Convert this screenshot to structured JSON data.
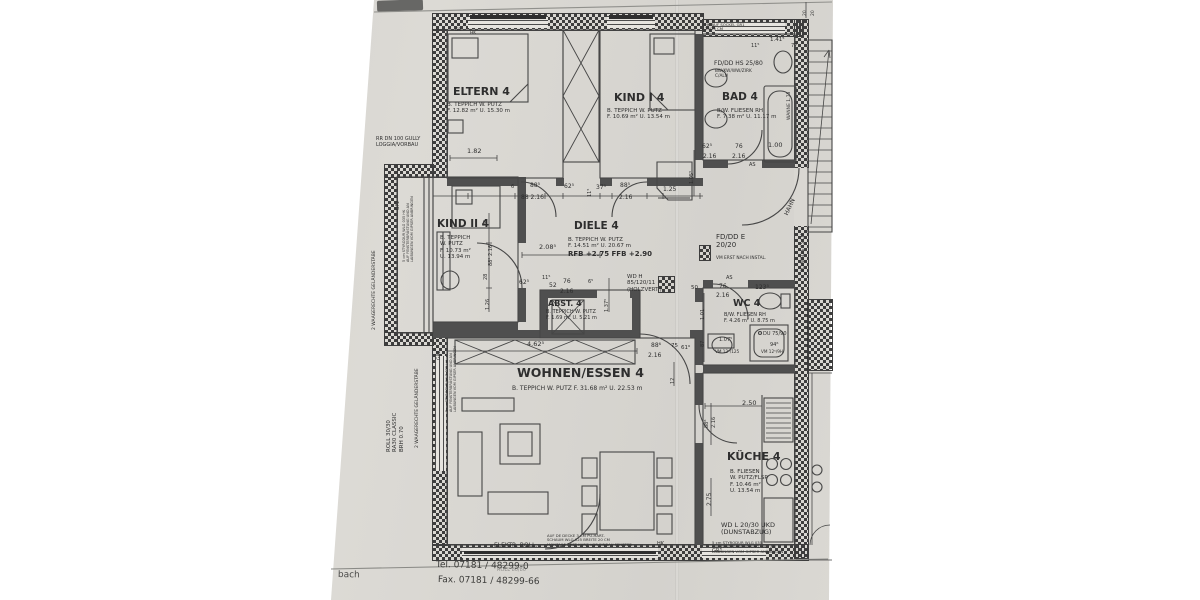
{
  "title": "apartment floor plan sheet (photo)",
  "accent_colors": {
    "paper": "#d6d4cf",
    "ink": "#3d3d3d"
  },
  "footer": {
    "left_fragment": "bach",
    "tel": "Tel. 07181 / 48299-0",
    "fax": "Fax. 07181 / 48299-66",
    "faint_stamp": "ROLL  80/80"
  },
  "rooms": [
    {
      "name": "ELTERN 4",
      "finish": "B. TEPPICH W. PUTZ",
      "area": "F. 12.82 m²",
      "perimeter": "U. 15.30 m"
    },
    {
      "name": "KIND I 4",
      "finish": "B. TEPPICH W. PUTZ",
      "area": "F. 10.69 m²",
      "perimeter": "U. 13.54 m"
    },
    {
      "name": "BAD 4",
      "finish": "B/W. FLIESEN RH",
      "area": "F. 7.38 m²",
      "perimeter": "U. 11.17 m"
    },
    {
      "name": "KIND II 4",
      "finish": "B. TEPPICH W. PUTZ",
      "area": "F. 10.73 m²",
      "perimeter": "U. 13.94 m"
    },
    {
      "name": "DIELE 4",
      "finish": "B. TEPPICH W. PUTZ",
      "area": "F. 14.51 m²",
      "perimeter": "U. 20.67 m",
      "levels": "RFB +2.75  FFB +2.90"
    },
    {
      "name": "ABST. 4",
      "finish": "B. TEPPICH W. PUTZ",
      "area": "F. 1.69 m²",
      "perimeter": "U. 5.21 m"
    },
    {
      "name": "WOHNEN/ESSEN 4",
      "finish": "B. TEPPICH W. PUTZ",
      "area": "F. 31.68 m²",
      "perimeter": "U. 22.53 m"
    },
    {
      "name": "WC 4",
      "finish": "B/W. FLIESEN RH",
      "area": "F. 4.26 m²",
      "perimeter": "U. 8.75 m"
    },
    {
      "name": "KÜCHE 4",
      "finish": "B. FLIESEN W. PUTZ/FLSP",
      "area": "F. 10.46 m²",
      "perimeter": "U. 13.54 m"
    }
  ],
  "labels": [
    {
      "n": "room-eltern-title",
      "t": "ELTERN 4",
      "x": 453,
      "y": 86,
      "s": 11,
      "b": 1
    },
    {
      "n": "room-eltern-spec",
      "t": "B. TEPPICH W. PUTZ\nF. 12.82 m²    U. 15.30 m",
      "x": 447,
      "y": 102,
      "s": 5.5
    },
    {
      "n": "room-kind1-title",
      "t": "KIND I 4",
      "x": 614,
      "y": 92,
      "s": 11,
      "b": 1
    },
    {
      "n": "room-kind1-spec",
      "t": "B. TEPPICH W. PUTZ\nF. 10.69 m²   U. 13.54 m",
      "x": 607,
      "y": 108,
      "s": 5.5
    },
    {
      "n": "room-bad-title",
      "t": "BAD 4",
      "x": 722,
      "y": 92,
      "s": 10.5,
      "b": 1
    },
    {
      "n": "room-bad-spec",
      "t": "B/W. FLIESEN RH\nF. 7.38 m²   U. 11.17 m",
      "x": 717,
      "y": 108,
      "s": 5.5
    },
    {
      "n": "room-kind2-title",
      "t": "KIND II 4",
      "x": 437,
      "y": 219,
      "s": 10.5,
      "b": 1
    },
    {
      "n": "room-kind2-spec",
      "t": "B. TEPPICH\nW. PUTZ\nF. 10.73 m²\nU. 13.94 m",
      "x": 440,
      "y": 235,
      "s": 5.5
    },
    {
      "n": "room-diele-title",
      "t": "DIELE 4",
      "x": 574,
      "y": 221,
      "s": 10.5,
      "b": 1
    },
    {
      "n": "room-diele-spec",
      "t": "B. TEPPICH W. PUTZ\nF. 14.51 m²   U. 20.67 m",
      "x": 568,
      "y": 237,
      "s": 5.5
    },
    {
      "n": "room-diele-levels",
      "t": "RFB +2.75  FFB +2.90",
      "x": 568,
      "y": 251,
      "s": 7,
      "b": 1
    },
    {
      "n": "room-abst-title",
      "t": "ABST. 4",
      "x": 548,
      "y": 299,
      "s": 8,
      "b": 1
    },
    {
      "n": "room-abst-spec",
      "t": "B. TEPPICH W. PUTZ\nF. 1.69 m²   U. 5.21 m",
      "x": 546,
      "y": 310,
      "s": 5
    },
    {
      "n": "room-wohnen-title",
      "t": "WOHNEN/ESSEN 4",
      "x": 517,
      "y": 366,
      "s": 12.5,
      "b": 1
    },
    {
      "n": "room-wohnen-spec",
      "t": "B. TEPPICH W. PUTZ   F. 31.68 m²   U. 22.53 m",
      "x": 512,
      "y": 386,
      "s": 6
    },
    {
      "n": "room-wc-title",
      "t": "WC 4",
      "x": 733,
      "y": 299,
      "s": 9.5,
      "b": 1
    },
    {
      "n": "room-wc-spec",
      "t": "B/W. FLIESEN RH\nF. 4.26 m²   U. 8.75 m",
      "x": 724,
      "y": 313,
      "s": 5
    },
    {
      "n": "room-kueche-title",
      "t": "KÜCHE 4",
      "x": 727,
      "y": 451,
      "s": 11,
      "b": 1
    },
    {
      "n": "room-kueche-spec",
      "t": "B. FLIESEN\nW. PUTZ/FLSP\nF. 10.46 m²\nU. 13.54 m",
      "x": 730,
      "y": 469,
      "s": 5.5
    },
    {
      "n": "note-gully",
      "t": "RR DN 100 GULLY\nLOGGIA/VORBAU",
      "x": 376,
      "y": 137,
      "s": 5
    },
    {
      "n": "note-fd-dd-hs",
      "t": "FD/DD HS 25/80",
      "x": 714,
      "y": 61,
      "s": 6
    },
    {
      "n": "note-fd-dd-hs-sub",
      "t": "BW/KW/WW/ZIRK\nC/ALU",
      "x": 715,
      "y": 70,
      "s": 4.3
    },
    {
      "n": "note-hk-sockel",
      "t": "HK AUF SOCKEL GR1\n25/25 CM",
      "x": 705,
      "y": 23,
      "s": 3.8
    },
    {
      "n": "note-fd-dd-e",
      "t": "FD/DD E\n20/20",
      "x": 716,
      "y": 234,
      "s": 7
    },
    {
      "n": "note-fd-dd-e-sub",
      "t": "VM ERST NACH INSTAL.",
      "x": 716,
      "y": 257,
      "s": 4.3
    },
    {
      "n": "note-wd-h",
      "t": "WD H\n85/120/11\n(HOLZVERT.)",
      "x": 627,
      "y": 274,
      "s": 5.5
    },
    {
      "n": "note-wd-l",
      "t": "WD L 20/30 UKD\n(DUNSTABZUG)",
      "x": 721,
      "y": 522,
      "s": 6.5
    },
    {
      "n": "note-styrodur-kueche",
      "t": "5 cm STYRODUR WLG 035\nAUF FENSTERBRÜSTUNG UND AN\nLAIBUNGEN VOM GIPSER ANBRINGEN",
      "x": 712,
      "y": 541,
      "s": 3.8
    },
    {
      "n": "note-pu-schaum",
      "t": "AUF DE DECKE 3 CM PU-HART-\nSCHAUM WLG 025 BREITE 20 CM\nMONTAGE ERST KURZ VOR EINBAU FENSTER",
      "x": 547,
      "y": 534,
      "s": 3.8
    },
    {
      "n": "note-elektr-roll",
      "t": "ELEKTR. ROLL.",
      "x": 494,
      "y": 543,
      "s": 6
    },
    {
      "n": "note-hk-bottom",
      "t": "HK",
      "x": 657,
      "y": 542,
      "s": 5
    },
    {
      "n": "note-gr1",
      "t": "GR1",
      "x": 712,
      "y": 549,
      "s": 5
    },
    {
      "n": "note-gr-top",
      "t": "GR",
      "x": 455,
      "y": 29,
      "s": 4.3
    },
    {
      "n": "note-hk-top",
      "t": "HK",
      "x": 470,
      "y": 32,
      "s": 4.3
    },
    {
      "n": "note-as-bad",
      "t": "AS",
      "x": 749,
      "y": 163,
      "s": 5
    },
    {
      "n": "note-as-wc",
      "t": "AS",
      "x": 726,
      "y": 276,
      "s": 5
    },
    {
      "n": "note-roll-3030",
      "t": "ROLL 30/30\nRA30 CLASSIC\nBRH 0.70",
      "x": 386,
      "y": 452,
      "s": 5.5,
      "r": -90
    },
    {
      "n": "note-gelaender",
      "t": "2 WAAGERECHTE GELÄNDERSTÄBE",
      "x": 415,
      "y": 448,
      "s": 4.5,
      "r": -90
    },
    {
      "n": "note-styrodur-left",
      "t": "5 cm STYRODUR WLG 035  HK\nAUF FENSTERBRÜSTUNG UND AN\nLAIBUNGEN VOM GIPSER ANBRINGEN",
      "x": 445,
      "y": 412,
      "s": 3.5,
      "r": -90
    },
    {
      "n": "note-gelaender-2",
      "t": "2 WAAGERECHTE GELÄNDERSTÄBE",
      "x": 372,
      "y": 330,
      "s": 4.5,
      "r": -90
    },
    {
      "n": "note-styrodur-left-2",
      "t": "5 cm STYRODUR WLG 035  HK\nAUF FENSTERBRÜSTUNG UND AN\nLAIBUNGEN VOM GIPSER ANBRINGEN",
      "x": 402,
      "y": 262,
      "s": 3.5,
      "r": -90
    },
    {
      "n": "note-gr2",
      "t": "GR2",
      "x": 437,
      "y": 360,
      "s": 4.5,
      "r": -90
    },
    {
      "n": "note-gp2",
      "t": "GP2",
      "x": 396,
      "y": 210,
      "s": 4.5,
      "r": -90
    },
    {
      "n": "note-wanne",
      "t": "WANNE 1.75",
      "x": 787,
      "y": 120,
      "s": 4.5,
      "r": -90
    },
    {
      "n": "note-schwelle",
      "t": "SCHWELLE 15 CM",
      "x": 802,
      "y": 272,
      "s": 4.3,
      "r": -90
    },
    {
      "n": "note-hahn",
      "t": "HAHN",
      "x": 784,
      "y": 214,
      "s": 6,
      "r": -65
    },
    {
      "n": "note-du-dusche",
      "t": "DU 75/90",
      "x": 763,
      "y": 332,
      "s": 5
    },
    {
      "n": "dim-94",
      "t": "94⁶",
      "x": 770,
      "y": 343,
      "s": 5
    },
    {
      "n": "note-vm125",
      "t": "VM 12⁵/125",
      "x": 715,
      "y": 350,
      "s": 4.2
    },
    {
      "n": "note-vm129",
      "t": "VM 12⁵/9H",
      "x": 761,
      "y": 350,
      "s": 4.2
    },
    {
      "t": "1.07⁵",
      "x": 719,
      "y": 338,
      "s": 5
    },
    {
      "t": "1.82",
      "x": 467,
      "y": 148,
      "s": 6.5
    },
    {
      "t": "6",
      "x": 511,
      "y": 185,
      "s": 5
    },
    {
      "t": "88⁵",
      "x": 530,
      "y": 183,
      "s": 6
    },
    {
      "t": "88  2.16",
      "x": 521,
      "y": 195,
      "s": 6
    },
    {
      "t": "62⁵",
      "x": 564,
      "y": 184,
      "s": 6
    },
    {
      "t": "11⁵",
      "x": 588,
      "y": 197,
      "s": 5,
      "r": -90
    },
    {
      "t": "37⁵",
      "x": 596,
      "y": 185,
      "s": 6
    },
    {
      "t": "88⁵",
      "x": 620,
      "y": 183,
      "s": 6
    },
    {
      "t": "2.16",
      "x": 619,
      "y": 195,
      "s": 6
    },
    {
      "t": "1.25",
      "x": 663,
      "y": 187,
      "s": 6
    },
    {
      "t": "1.05⁵",
      "x": 690,
      "y": 184,
      "s": 5,
      "r": -90
    },
    {
      "t": "62⁵",
      "x": 702,
      "y": 144,
      "s": 6
    },
    {
      "t": "2.16",
      "x": 703,
      "y": 154,
      "s": 6
    },
    {
      "t": "76",
      "x": 735,
      "y": 144,
      "s": 6
    },
    {
      "t": "2.16",
      "x": 732,
      "y": 154,
      "s": 6
    },
    {
      "t": "1.00",
      "x": 768,
      "y": 142,
      "s": 6.5
    },
    {
      "t": "11⁵",
      "x": 751,
      "y": 44,
      "s": 5
    },
    {
      "t": "1.41⁵",
      "x": 770,
      "y": 37,
      "s": 5.5
    },
    {
      "t": "77",
      "x": 791,
      "y": 44,
      "s": 5
    },
    {
      "t": "20",
      "x": 803,
      "y": 16,
      "s": 4.5,
      "r": -90
    },
    {
      "t": "20",
      "x": 811,
      "y": 16,
      "s": 4.5,
      "r": -90
    },
    {
      "t": "2.08⁵",
      "x": 539,
      "y": 244,
      "s": 6.5
    },
    {
      "t": "26",
      "x": 484,
      "y": 226,
      "s": 5,
      "r": -90
    },
    {
      "t": "88⁵  2.16",
      "x": 489,
      "y": 266,
      "s": 5,
      "r": -90
    },
    {
      "t": "28",
      "x": 484,
      "y": 280,
      "s": 5,
      "r": -90
    },
    {
      "t": "1.26",
      "x": 486,
      "y": 310,
      "s": 5,
      "r": -90
    },
    {
      "t": "62⁵",
      "x": 519,
      "y": 280,
      "s": 6
    },
    {
      "t": "11⁵",
      "x": 542,
      "y": 276,
      "s": 5
    },
    {
      "t": "52",
      "x": 549,
      "y": 283,
      "s": 6
    },
    {
      "t": "76",
      "x": 563,
      "y": 279,
      "s": 6
    },
    {
      "t": "2.16",
      "x": 560,
      "y": 289,
      "s": 6
    },
    {
      "t": "6⁵",
      "x": 588,
      "y": 280,
      "s": 5
    },
    {
      "t": "1.37⁵",
      "x": 605,
      "y": 312,
      "s": 5,
      "r": -90
    },
    {
      "t": "50",
      "x": 691,
      "y": 285,
      "s": 5.5
    },
    {
      "t": "76",
      "x": 719,
      "y": 284,
      "s": 6
    },
    {
      "t": "2.16",
      "x": 716,
      "y": 293,
      "s": 6
    },
    {
      "t": "123⁵",
      "x": 755,
      "y": 285,
      "s": 6
    },
    {
      "t": "1.01",
      "x": 701,
      "y": 320,
      "s": 5,
      "r": -90
    },
    {
      "t": "87",
      "x": 701,
      "y": 347,
      "s": 5,
      "r": -90
    },
    {
      "t": "4.62⁵",
      "x": 527,
      "y": 341,
      "s": 6.5
    },
    {
      "t": "88⁶",
      "x": 651,
      "y": 343,
      "s": 6
    },
    {
      "t": "2.16",
      "x": 648,
      "y": 353,
      "s": 6
    },
    {
      "t": "75",
      "x": 671,
      "y": 343,
      "s": 5.5
    },
    {
      "t": "61⁶",
      "x": 681,
      "y": 345,
      "s": 5.5
    },
    {
      "t": "12",
      "x": 671,
      "y": 384,
      "s": 5,
      "r": -90
    },
    {
      "t": "2.50",
      "x": 742,
      "y": 400,
      "s": 6.5
    },
    {
      "t": "88⁶",
      "x": 705,
      "y": 428,
      "s": 5,
      "r": -90
    },
    {
      "t": "2.16",
      "x": 712,
      "y": 428,
      "s": 5,
      "r": -90
    },
    {
      "t": "2.75",
      "x": 707,
      "y": 506,
      "s": 6,
      "r": -90
    },
    {
      "n": "footer-left-fragment",
      "t": "bach",
      "x": 338,
      "y": 570,
      "s": 9,
      "c": "#4a4a48",
      "r": 1
    },
    {
      "n": "footer-tel",
      "t": "Tel. 07181 / 48299-0",
      "x": 436,
      "y": 560,
      "s": 9,
      "c": "#3c3c3a",
      "r": 1.2
    },
    {
      "n": "footer-fax",
      "t": "Fax. 07181 / 48299-66",
      "x": 438,
      "y": 575,
      "s": 9,
      "c": "#3c3c3a",
      "r": 1.2
    },
    {
      "n": "footer-faint-stamp",
      "t": "ROLL  80/80",
      "x": 497,
      "y": 568,
      "s": 5,
      "o": 0.45
    }
  ]
}
